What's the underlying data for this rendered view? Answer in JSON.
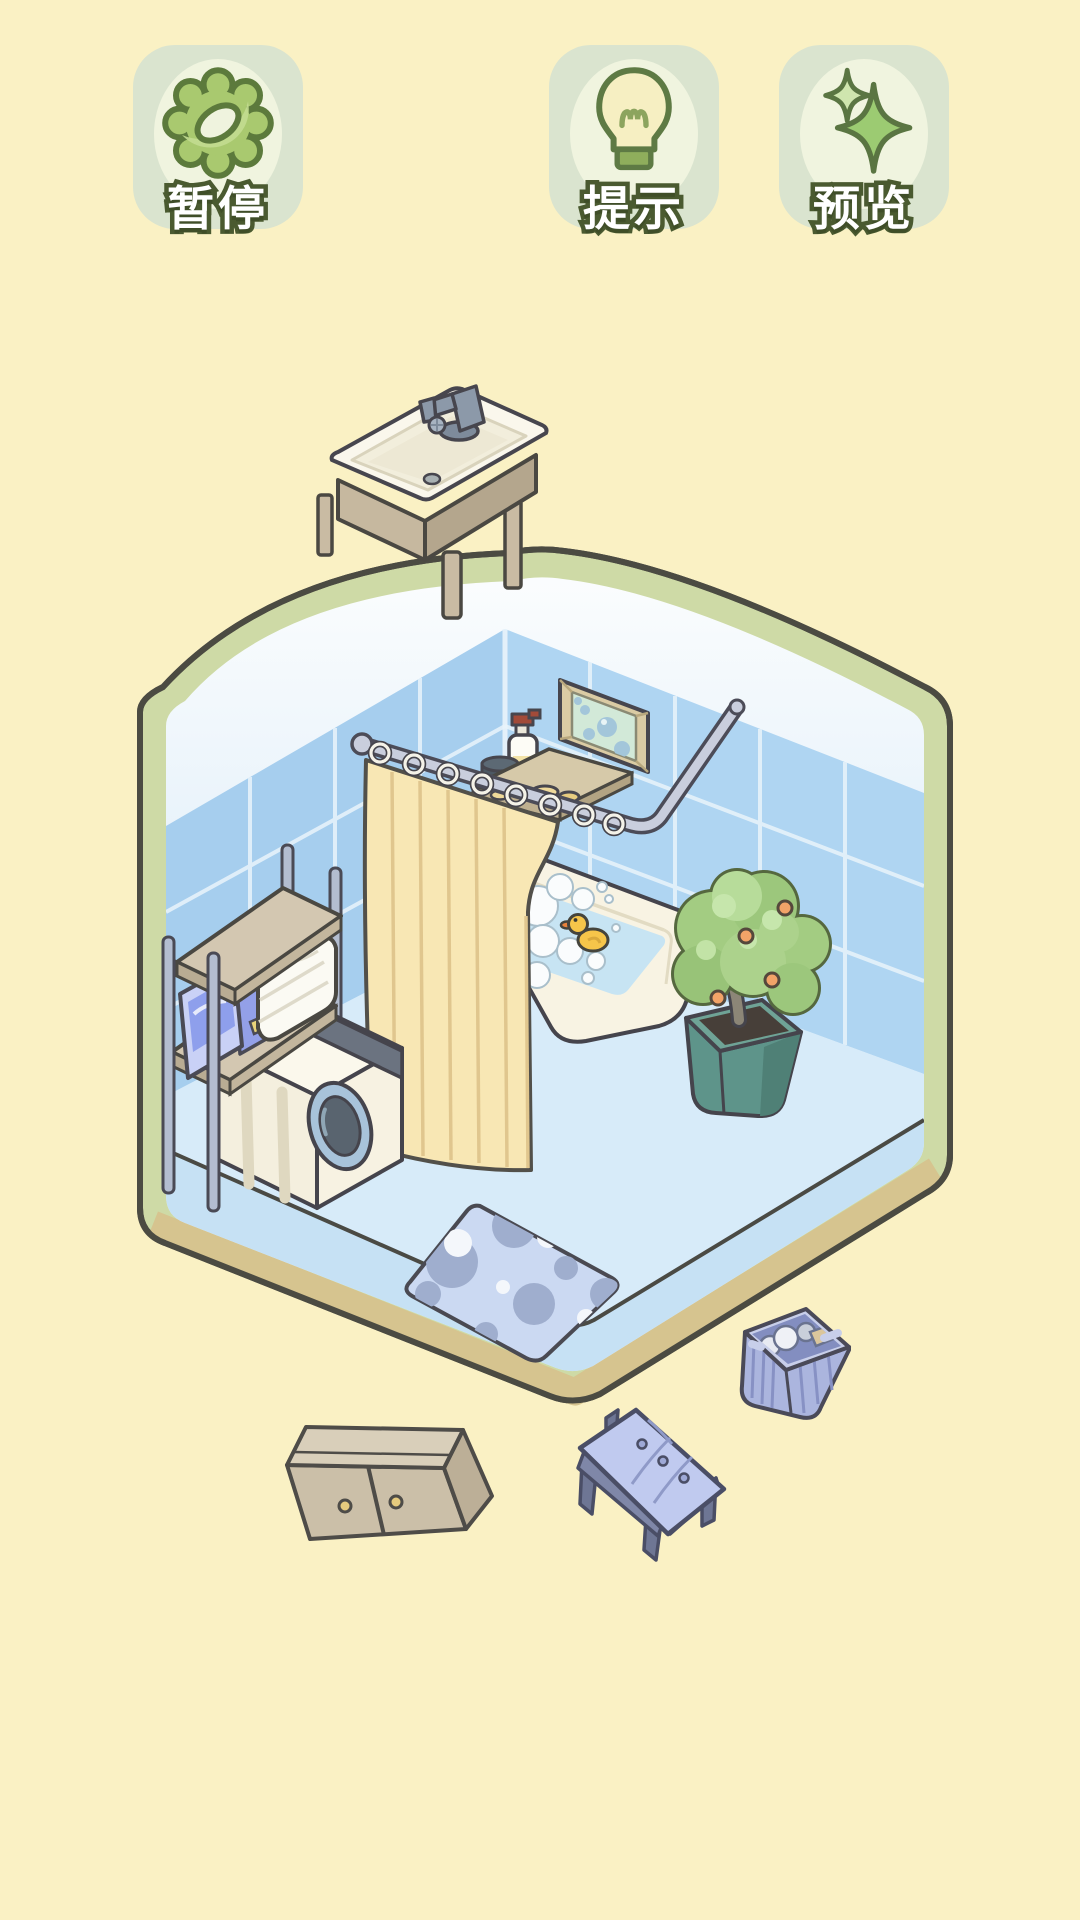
{
  "app": {
    "background_color": "#FAF1C4",
    "type": "isometric room decoration puzzle"
  },
  "toolbar": {
    "pause": {
      "label": "暂停",
      "icon": "gear-icon"
    },
    "hint": {
      "label": "提示",
      "icon": "lightbulb-icon"
    },
    "preview": {
      "label": "预览",
      "icon": "sparkle-stars-icon"
    }
  },
  "scene": {
    "room": {
      "shape": "isometric-hexagon-bathroom",
      "border_color": "#CEDAA6",
      "border_bottom_color": "#D6C48F",
      "tile_color_left_wall": "#A6CEEE",
      "tile_color_right_wall": "#AFD5F2",
      "upper_wall_color": "#F5FAFD",
      "floor_color": "#D7EBF9",
      "floor_side_color": "#C6E1F4"
    },
    "placed_items": [
      "wall-picture-bubbles",
      "shower-curtain-rod",
      "shower-curtain",
      "corner-shelf-with-toiletries",
      "bathtub-with-foam-and-duck",
      "potted-fruit-tree",
      "laundry-rack-shelf",
      "folded-towels",
      "detergent-boxes",
      "washing-machine",
      "polka-dot-rug"
    ],
    "loose_items": [
      "sink-vanity",
      "laundry-basket",
      "storage-cabinet",
      "tufted-bench"
    ],
    "accents": {
      "curtain_color": "#F8E7B4",
      "duck_color": "#F6C54A",
      "rug_color": "#CBD9F2",
      "basket_color": "#ABB5DE",
      "pot_color": "#5E948A",
      "cabinet_color": "#CBBFA8"
    }
  }
}
